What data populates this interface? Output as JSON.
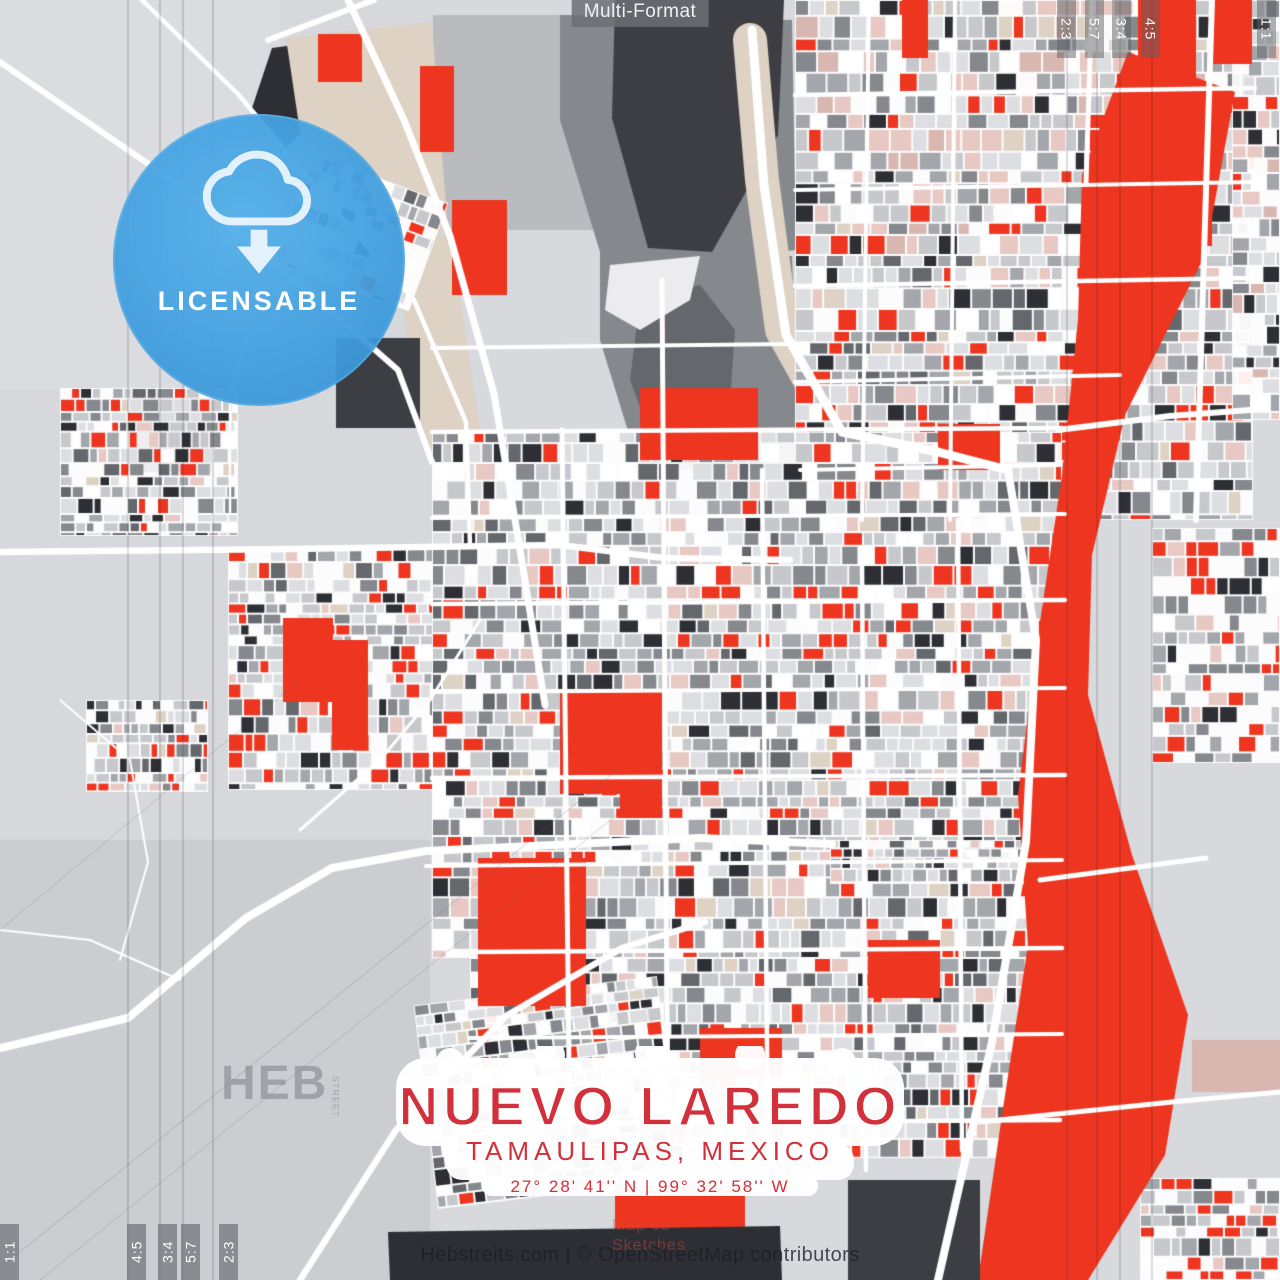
{
  "template": {
    "format_label": "Multi-Format"
  },
  "badge": {
    "label": "LICENSABLE",
    "icon": "cloud-download-icon"
  },
  "title_block": {
    "city": "NUEVO LAREDO",
    "region": "TAMAULIPAS, MEXICO",
    "coordinates": "27° 28' 41'' N | 99° 32' 58'' W"
  },
  "watermarks": {
    "brand_large": "HEB",
    "brand_small": "STREET",
    "tile_line1": "Map co",
    "tile_line2": "Sketches"
  },
  "attribution": {
    "text": "Hebstreits.com | © OpenStreetMap contributors"
  },
  "crop_marks": {
    "bottom_left": [
      "1:1",
      "4:5",
      "3:4",
      "5:7",
      "2:3"
    ],
    "top_right": [
      "2:3",
      "5:7",
      "3:4",
      "4:5",
      "1:1"
    ]
  },
  "map_colors": {
    "base": "#d7d9dd",
    "rural": "#d6d8dc",
    "rural_dark": "#cbcdd1",
    "rural_light": "#dadce0",
    "road": "#ffffff",
    "red": "#ee3520",
    "title_red": "#d2303a",
    "charcoal": "#2d2f34",
    "dark": "#3c3e43",
    "mid_dark": "#64676c",
    "grey": "#85888d",
    "mid": "#a3a6ab",
    "light": "#c6c8cc",
    "lighter": "#dcdee1",
    "pink": "#e7c8c3",
    "dusty": "#d9b7b1",
    "beige": "#ddd2c3",
    "cream": "#e9e2d6",
    "badge_blue": "#3fa0e4",
    "badge_icon": "#e2f1fc",
    "guide": "rgba(45,47,52,0.33)"
  }
}
